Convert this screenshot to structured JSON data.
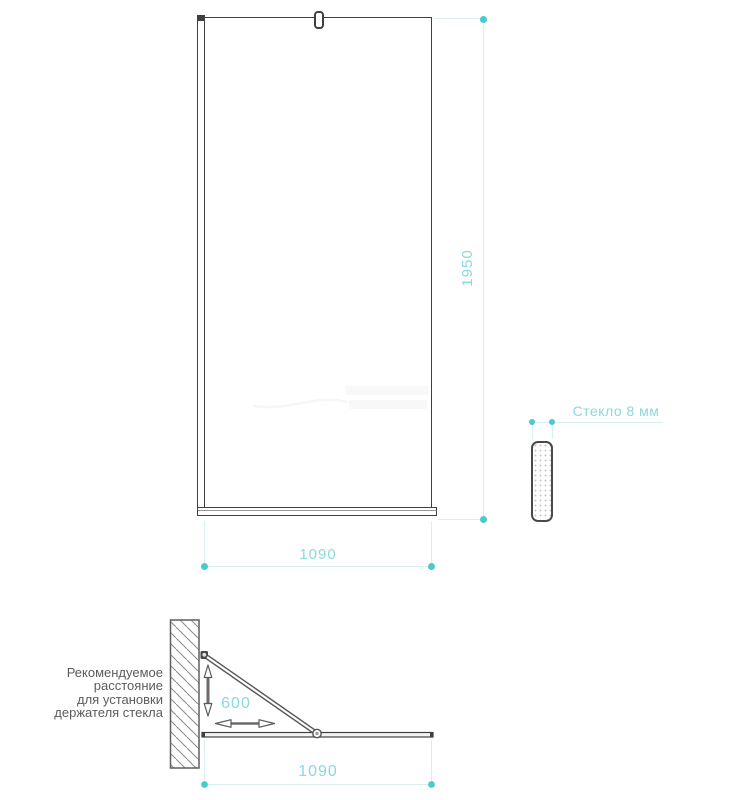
{
  "colors": {
    "accent_teal_text": "#8bd8dd",
    "accent_teal_dot": "#4cc9d0",
    "dimension_guide_line": "#d9eff0",
    "drawing_line": "#3f3f3f"
  },
  "front_view": {
    "height_dim": "1950",
    "width_dim": "1090"
  },
  "glass_section": {
    "label": "Стекло 8 мм"
  },
  "installation_view": {
    "note_lines": [
      "Рекомендуемое",
      "расстояние",
      "для установки",
      "держателя стекла"
    ],
    "holder_distance": "600",
    "width_dim": "1090"
  }
}
